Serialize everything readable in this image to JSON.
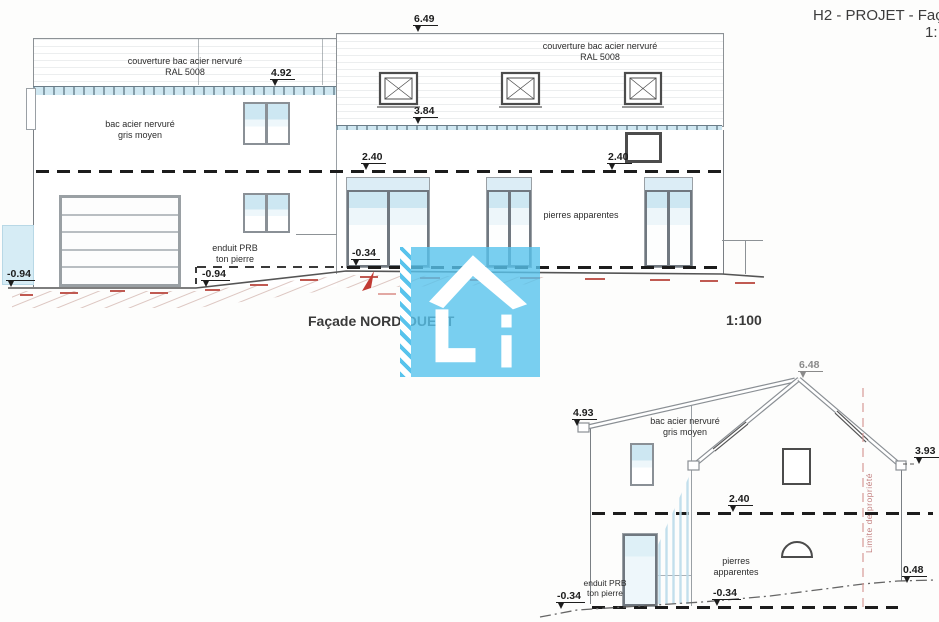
{
  "header": {
    "title_clipped": "H2 - PROJET - Façade",
    "scale_clipped": "1:"
  },
  "main_elevation": {
    "title": "Façade NORD-OUEST",
    "scale": "1:100",
    "materials": {
      "roof_left": "couverture bac acier nervuré\nRAL 5008",
      "roof_right": "couverture bac acier nervuré\nRAL 5008",
      "wall_upper_left": "bac acier nervuré\ngris moyen",
      "wall_render": "enduit PRB\nton pierre",
      "wall_stone": "pierres apparentes"
    },
    "levels": {
      "ridge": "6.49",
      "eaves_left": "4.92",
      "eaves_right": "3.84",
      "upper_floor_left": "2.40",
      "upper_floor_right": "2.40",
      "ground_floor": "-0.34",
      "ground_left": "-0.94",
      "ground_mid": "-0.94"
    }
  },
  "side_elevation": {
    "materials": {
      "roof": "bac acier nervuré\ngris moyen",
      "wall_stone": "pierres apparentes",
      "wall_render": "enduit PRB\nton pierre"
    },
    "levels": {
      "ridge": "6.48",
      "eaves_left": "4.93",
      "eaves_right": "3.93",
      "upper_floor": "2.40",
      "ground_right": "0.48",
      "ground_left": "-0.34",
      "floor_ground": "-0.34"
    },
    "property_line_label": "Limite de propriété"
  },
  "colors": {
    "logo_blue": "#58c3ec",
    "glass_blue": "#cde7f2",
    "terrain_red": "#c05a52",
    "line_dark": "#1d1d1d"
  }
}
